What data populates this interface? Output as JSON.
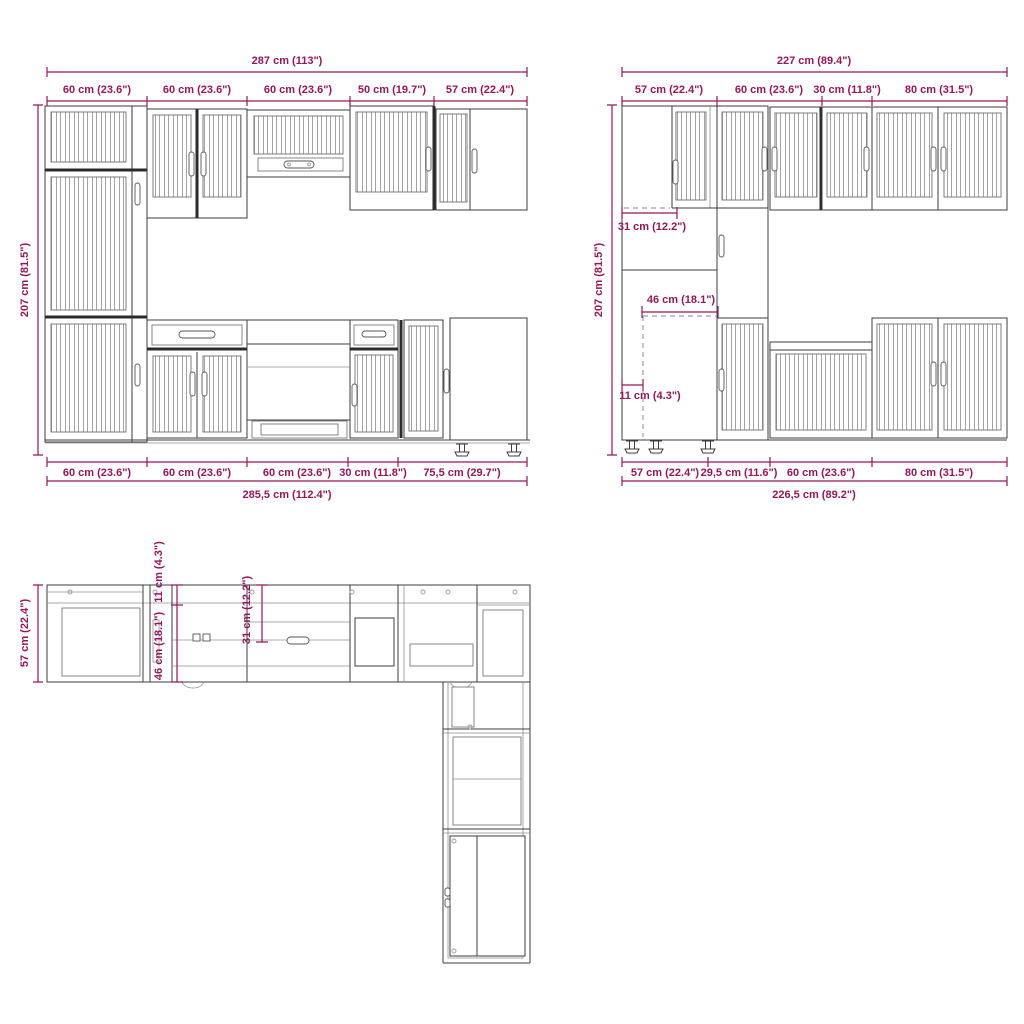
{
  "title": "Kitchen cabinet set dimension drawing",
  "colors": {
    "dimension": "#93175b",
    "outline": "#3d3d3d",
    "detail": "#8f8f8f",
    "background": "#ffffff"
  },
  "front_elevation": {
    "total_width": "287 cm (113\")",
    "height": "207 cm (81.5\")",
    "top_widths": [
      "60 cm (23.6\")",
      "60 cm (23.6\")",
      "60 cm (23.6\")",
      "50 cm (19.7\")",
      "57 cm (22.4\")"
    ],
    "bottom_widths": [
      "60 cm (23.6\")",
      "60 cm (23.6\")",
      "60 cm (23.6\")",
      "30 cm (11.8\")",
      "75,5 cm (29.7\")"
    ],
    "total_width_bottom": "285,5 cm (112.4\")"
  },
  "side_elevation": {
    "total_width": "227 cm (89.4\")",
    "height": "207 cm (81.5\")",
    "top_widths": [
      "57 cm (22.4\")",
      "60 cm (23.6\")",
      "30 cm (11.8\")",
      "80 cm (31.5\")"
    ],
    "inner": {
      "fridge_recess_width": "31 cm (12.2\")",
      "fridge_recess_depth": "46 cm (18.1\")",
      "plinth_offset": "11 cm (4.3\")"
    },
    "bottom_widths": [
      "57 cm (22.4\")",
      "29,5 cm (11.6\")",
      "60 cm (23.6\")",
      "80 cm (31.5\")"
    ],
    "total_width_bottom": "226,5 cm (89.2\")"
  },
  "plan_view": {
    "depth": "57 cm (22.4\")",
    "inner": {
      "offset": "11 cm (4.3\")",
      "recess_depth": "46 cm (18.1\")",
      "recess_width": "31 cm (12.2\")"
    }
  }
}
